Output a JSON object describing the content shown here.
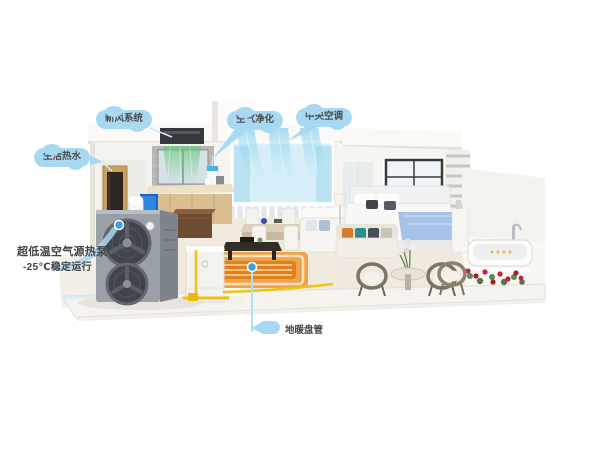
{
  "title": "空气源热泵全屋冷暖示意图",
  "callouts": {
    "fresh_air": {
      "label": "新风系统"
    },
    "air_purify": {
      "label": "空气净化"
    },
    "central_ac": {
      "label": "中央空调"
    },
    "hot_water": {
      "label": "生活热水"
    },
    "heat_pump": {
      "line1": "超低温空气源热泵",
      "line2": "-25℃稳定运行"
    },
    "floor_heating": {
      "label": "地暖盘管"
    }
  },
  "colors": {
    "callout_bg": "#a9d9f2",
    "callout_text": "#4c4c4c",
    "anchor_dot": "#3f9fdc",
    "pointer_line": "#ace0f6",
    "airflow_green": "#5ec878",
    "airflow_cyan": "#6fc9ea",
    "floor_heating_orange": "#ef9a3a",
    "pipe_yellow": "#edc412"
  }
}
